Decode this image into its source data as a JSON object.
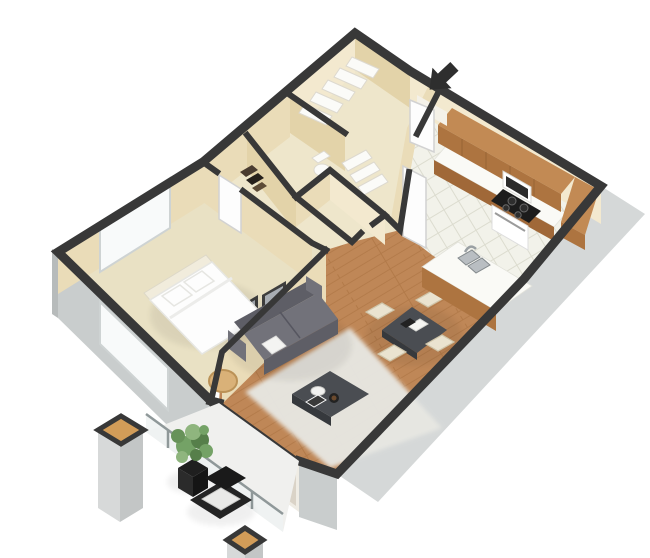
{
  "scene": {
    "label": "3D isometric cutaway floor plan of a one-bedroom apartment, viewed from above with white background",
    "entry_marker": "black arrow pointing at front door (top right)",
    "rooms": [
      {
        "name": "bedroom",
        "floor": "beige carpet",
        "contents": [
          "double bed with two pillows",
          "window on upper-left wall",
          "open white door"
        ]
      },
      {
        "name": "living-room",
        "floor": "wood planks",
        "contents": [
          "gray sofa with white pillow",
          "dark coffee table with bowl and books",
          "shag rug",
          "two framed pictures on wall",
          "tan ottoman",
          "sliding glass doors to balcony"
        ]
      },
      {
        "name": "dining-area",
        "floor": "wood planks",
        "contents": [
          "dark gray dining table",
          "four cream chairs",
          "papers and tablet on table"
        ]
      },
      {
        "name": "kitchen",
        "floor": "white tile",
        "contents": [
          "L-shaped wood upper cabinets",
          "white countertop",
          "range with black cooktop",
          "microwave",
          "island with double sink and faucet"
        ]
      },
      {
        "name": "bathroom",
        "contents": [
          "toilet",
          "white towel shelves"
        ]
      },
      {
        "name": "hallway",
        "contents": [
          "storage closet with dark stacked items",
          "open door to kitchen"
        ]
      },
      {
        "name": "linen-closet",
        "contents": [
          "five white shelves"
        ]
      },
      {
        "name": "balcony",
        "floor": "white concrete",
        "contents": [
          "potted green plant in black planter",
          "black lounge chair with white cushion",
          "two gray pillars with tan caps",
          "glass railing"
        ]
      }
    ]
  },
  "colors": {
    "bg": "#ffffff",
    "wall_dark": "#383838",
    "wall_beige": "#eadcb8",
    "wall_beige_light": "#f3e9cf",
    "wall_beige_mid": "#e3d3a9",
    "floor_beige": "#e9e1c4",
    "floor_hall": "#eee6cb",
    "floor_wood": "#bf8757",
    "wood_line": "#a76f3e",
    "tile": "#f2f2ea",
    "tile_line": "#dcdccf",
    "ext_gray": "#c9cdcd",
    "ext_gray_light": "#d5d8d8",
    "ext_gray_dark": "#b7bbbb",
    "window_white": "#f8fafa",
    "window_frame": "#ced3d3",
    "door_white": "#fdfdfd",
    "door_frame": "#d2d2d2",
    "bed_white": "#fdfdfd",
    "bed_edge": "#e6e6e2",
    "sofa": "#72727a",
    "sofa_dark": "#5e5e66",
    "charcoal": "#4a4d52",
    "charcoal_dark": "#36393d",
    "cream": "#eae3d0",
    "cream_dark": "#cfc5aa",
    "cabinet": "#c28a54",
    "cabinet_dark": "#ad7440",
    "cabinet_seam": "#8a5a2e",
    "counter": "#fafaf6",
    "rug": "#e7e7e2",
    "tan": "#d9b178",
    "pillar_top": "#d29c58",
    "plant_green": "#74a266",
    "plant_green_dark": "#567f4a",
    "plant_green_light": "#8fb57e",
    "black": "#1f1f1f",
    "glass": "#c9c0ae",
    "steel": "#b9bec2",
    "arrow": "#2e2e2e",
    "frame_dark": "#3e3e3e",
    "art_gray": "#a8adb3",
    "rail": "#8f9899",
    "rail_glass": "#eef2f2",
    "balcony_floor": "#f0f0ee",
    "fixture_white": "#fbfbf8"
  }
}
